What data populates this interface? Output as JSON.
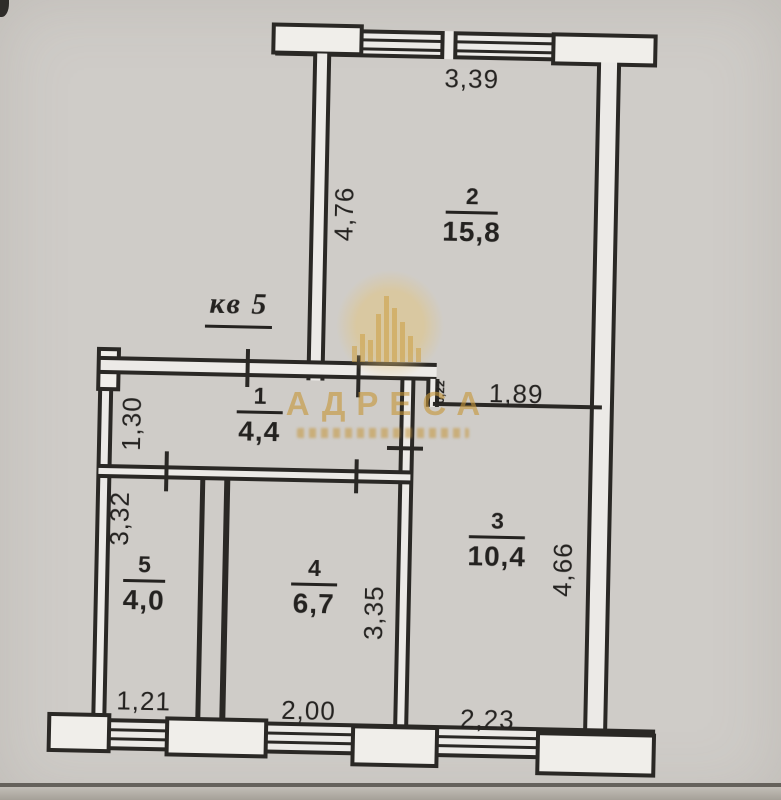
{
  "document": {
    "apartment_label": "кв 5"
  },
  "watermark": {
    "title": "АДРЕСА"
  },
  "rooms": [
    {
      "number": "2",
      "area": "15,8"
    },
    {
      "number": "1",
      "area": "4,4"
    },
    {
      "number": "3",
      "area": "10,4"
    },
    {
      "number": "4",
      "area": "6,7"
    },
    {
      "number": "5",
      "area": "4,0"
    }
  ],
  "dimensions": {
    "top_width": "3,39",
    "room2_left_height": "4,76",
    "room2_bottom_right": "1,89",
    "wall_offset": "0,22",
    "hall_left": "1,30",
    "room5_left": "3,32",
    "room4_right": "3,35",
    "room3_right": "4,66",
    "bottom_left_window": "1,21",
    "bottom_middle_window": "2,00",
    "bottom_right_window": "2,23"
  },
  "colors": {
    "ink": "#2a2825",
    "paper": "#e8e6e3",
    "watermark_gold": "#c59a3c"
  }
}
